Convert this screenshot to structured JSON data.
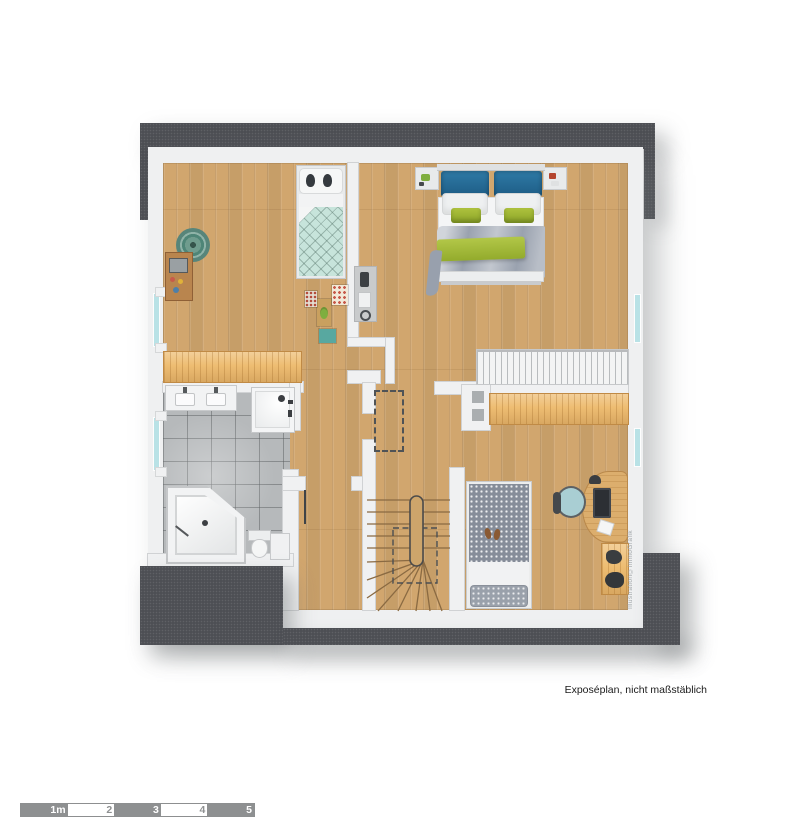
{
  "texts": {
    "footnote": "Exposéplan, nicht maßstäblich",
    "watermark": "Illustration©immoGrafik"
  },
  "scale_bar": {
    "labels": [
      "1m",
      "2",
      "3",
      "4",
      "5"
    ],
    "segment_gray": "#8e9091",
    "segment_white": "#ffffff"
  },
  "palette": {
    "roof_dark": "#4d4f54",
    "wall_white": "#f0f1f2",
    "wood_floor": "#d1a66e",
    "wood_bright": "#eebd72",
    "tile_gray": "#b6b9bb",
    "window_glass": "#b9e2e6",
    "mint_duvet": "#c7e4db",
    "blue_pillow": "#2a6b94",
    "green_accent": "#9cb232",
    "duvet_gray": "#9aa2af",
    "chair_teal": "#a9ced3"
  },
  "elements": {
    "rooms": [
      "child-bedroom",
      "master-bedroom",
      "hallway",
      "bathroom",
      "storage-closet",
      "bedroom-office"
    ],
    "furniture": [
      "child-bed",
      "double-bed",
      "single-bed",
      "wardrobe",
      "nightstand",
      "desk",
      "office-chair",
      "side-table",
      "knee-wall-bench",
      "wall-shelf",
      "round-rug",
      "corner-bathtub",
      "shower",
      "double-vanity",
      "toilet",
      "winder-staircase"
    ]
  }
}
